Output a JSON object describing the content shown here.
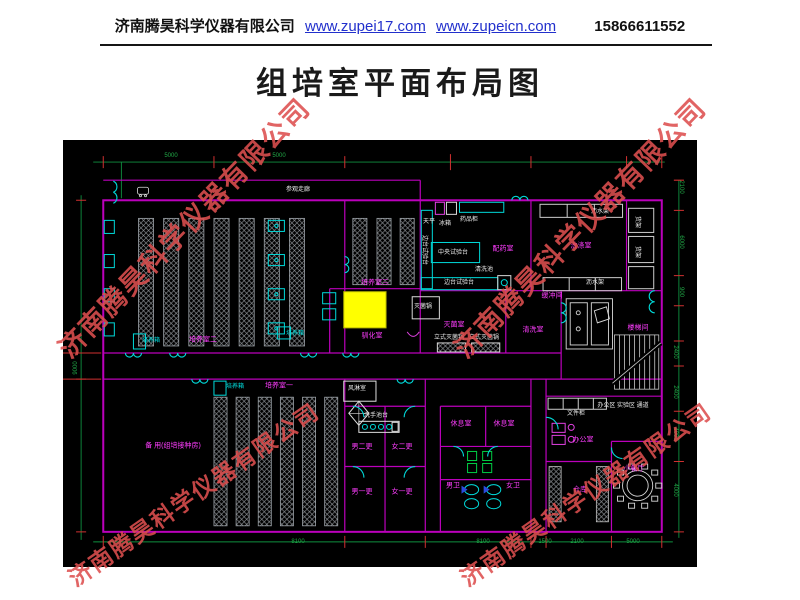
{
  "header": {
    "company": "济南腾昊科学仪器有限公司",
    "url1": "www.zupei17.com",
    "url2": "www.zupeicn.com",
    "phone": "15866611552"
  },
  "title": "组培室平面布局图",
  "watermark": {
    "text": "济南腾昊科学仪器有限公司",
    "color": "#dd4f4f",
    "instances": [
      {
        "x": 62,
        "y": 332,
        "r": -46,
        "s": 27
      },
      {
        "x": 458,
        "y": 332,
        "r": -46,
        "s": 27
      },
      {
        "x": 70,
        "y": 562,
        "r": -35,
        "s": 23
      },
      {
        "x": 462,
        "y": 562,
        "r": -35,
        "s": 23
      }
    ]
  },
  "colors": {
    "wall": "#bb00bb",
    "door": "#00d9d9",
    "room_label": "#ff3dff",
    "equipment": "#d8d8d8",
    "dimension": "#21a947",
    "tick": "#d03030",
    "highlight": "#ffff00",
    "plan_bg": "#000000"
  },
  "plan": {
    "labels": [
      {
        "t": "参观走廊",
        "c": "eq",
        "x": 235,
        "y": 50,
        "n": "label-visitor-corridor"
      },
      {
        "t": "培养室二",
        "c": "room",
        "x": 140,
        "y": 200,
        "n": "label-culture-room-2"
      },
      {
        "t": "培养室三",
        "c": "room",
        "x": 312,
        "y": 143,
        "n": "label-culture-room-3"
      },
      {
        "t": "驯化室",
        "c": "room",
        "x": 309,
        "y": 196,
        "n": "label-acclimatization-room"
      },
      {
        "t": "培养室一",
        "c": "room",
        "x": 216,
        "y": 246,
        "n": "label-culture-room-1"
      },
      {
        "t": "备 用(组培接种房)",
        "c": "room",
        "x": 110,
        "y": 306,
        "n": "label-spare-room"
      },
      {
        "t": "配药室",
        "c": "room",
        "x": 440,
        "y": 109,
        "n": "label-media-prep-room"
      },
      {
        "t": "洗涤室",
        "c": "room",
        "x": 518,
        "y": 106,
        "n": "label-washing-room"
      },
      {
        "t": "灭菌室",
        "c": "room",
        "x": 391,
        "y": 185,
        "n": "label-sterilization-room"
      },
      {
        "t": "清洗室",
        "c": "room",
        "x": 470,
        "y": 190,
        "n": "label-cleaning-room"
      },
      {
        "t": "缓冲间",
        "c": "room",
        "x": 489,
        "y": 156,
        "n": "label-buffer-room"
      },
      {
        "t": "楼梯间",
        "c": "room",
        "x": 575,
        "y": 188,
        "n": "label-stairwell"
      },
      {
        "t": "休息室",
        "c": "room",
        "x": 398,
        "y": 284,
        "n": "label-rest-room-1"
      },
      {
        "t": "休息室",
        "c": "room",
        "x": 441,
        "y": 284,
        "n": "label-rest-room-2"
      },
      {
        "t": "男二更",
        "c": "room",
        "x": 299,
        "y": 307,
        "n": "label-men-change-2"
      },
      {
        "t": "女二更",
        "c": "room",
        "x": 339,
        "y": 307,
        "n": "label-women-change-2"
      },
      {
        "t": "男一更",
        "c": "room",
        "x": 299,
        "y": 352,
        "n": "label-men-change-1"
      },
      {
        "t": "女一更",
        "c": "room",
        "x": 339,
        "y": 352,
        "n": "label-women-change-1"
      },
      {
        "t": "男卫",
        "c": "room",
        "x": 390,
        "y": 346,
        "n": "label-men-toilet"
      },
      {
        "t": "女卫",
        "c": "room",
        "x": 450,
        "y": 346,
        "n": "label-women-toilet"
      },
      {
        "t": "办公室",
        "c": "room",
        "x": 520,
        "y": 300,
        "n": "label-office"
      },
      {
        "t": "仓库",
        "c": "room",
        "x": 517,
        "y": 350,
        "n": "label-storage"
      },
      {
        "t": "小餐厅",
        "c": "room",
        "x": 571,
        "y": 329,
        "n": "label-small-dining"
      },
      {
        "t": "培养箱",
        "c": "cy",
        "x": 88,
        "y": 201,
        "n": "label-incubator"
      },
      {
        "t": "培养箱",
        "c": "cy",
        "x": 172,
        "y": 247,
        "n": "label-incubator"
      },
      {
        "t": "培养箱",
        "c": "cy",
        "x": 232,
        "y": 194,
        "n": "label-incubator"
      },
      {
        "t": "天平",
        "c": "eq",
        "x": 366,
        "y": 82,
        "n": "label-balance"
      },
      {
        "t": "冰箱",
        "c": "eq",
        "x": 382,
        "y": 84,
        "n": "label-fridge"
      },
      {
        "t": "药品柜",
        "c": "eq",
        "x": 406,
        "y": 80,
        "n": "label-medicine-cabinet"
      },
      {
        "t": "中央试验台",
        "c": "eq",
        "x": 390,
        "y": 113,
        "n": "label-central-bench"
      },
      {
        "t": "边台试验台",
        "c": "eq",
        "x": 361,
        "y": 110,
        "r": 90,
        "n": "label-side-bench"
      },
      {
        "t": "边台试验台",
        "c": "eq",
        "x": 396,
        "y": 143,
        "n": "label-side-bench"
      },
      {
        "t": "清洗池",
        "c": "eq",
        "x": 421,
        "y": 130,
        "n": "label-wash-sink"
      },
      {
        "t": "沥水架",
        "c": "eq",
        "x": 537,
        "y": 72,
        "n": "label-drain-rack"
      },
      {
        "t": "沥水架",
        "c": "eq",
        "x": 532,
        "y": 143,
        "n": "label-drain-rack"
      },
      {
        "t": "货架",
        "c": "eq",
        "x": 574,
        "y": 82,
        "r": 90,
        "n": "label-shelf"
      },
      {
        "t": "货架",
        "c": "eq",
        "x": 574,
        "y": 112,
        "r": 90,
        "n": "label-shelf"
      },
      {
        "t": "灭菌锅",
        "c": "eq",
        "x": 360,
        "y": 167,
        "n": "label-autoclave"
      },
      {
        "t": "立式灭菌锅",
        "c": "eq",
        "x": 386,
        "y": 198,
        "n": "label-vertical-autoclave"
      },
      {
        "t": "立式灭菌锅",
        "c": "eq",
        "x": 421,
        "y": 198,
        "n": "label-vertical-autoclave"
      },
      {
        "t": "风淋室",
        "c": "eq",
        "x": 294,
        "y": 249,
        "n": "label-air-shower"
      },
      {
        "t": "洗手池台",
        "c": "eq",
        "x": 313,
        "y": 276,
        "n": "label-hand-wash-counter"
      },
      {
        "t": "文件柜",
        "c": "eq",
        "x": 513,
        "y": 274,
        "n": "label-file-cabinet"
      },
      {
        "t": "办公区 实验区 通道",
        "c": "eq",
        "x": 560,
        "y": 266,
        "n": "label-corridor-note"
      },
      {
        "t": "5000",
        "c": "dim",
        "x": 108,
        "y": 16
      },
      {
        "t": "5000",
        "c": "dim",
        "x": 216,
        "y": 16
      },
      {
        "t": "9000",
        "c": "dim",
        "x": 13,
        "y": 228,
        "r": -90
      },
      {
        "t": "2100",
        "c": "dim",
        "x": 618,
        "y": 47,
        "r": 90
      },
      {
        "t": "6000",
        "c": "dim",
        "x": 618,
        "y": 102,
        "r": 90
      },
      {
        "t": "900",
        "c": "dim",
        "x": 618,
        "y": 152,
        "r": 90
      },
      {
        "t": "2400",
        "c": "dim",
        "x": 612,
        "y": 212,
        "r": 90
      },
      {
        "t": "2400",
        "c": "dim",
        "x": 612,
        "y": 252,
        "r": 90
      },
      {
        "t": "4000",
        "c": "dim",
        "x": 612,
        "y": 294,
        "r": 90
      },
      {
        "t": "4000",
        "c": "dim",
        "x": 612,
        "y": 350,
        "r": 90
      },
      {
        "t": "8100",
        "c": "dim",
        "x": 235,
        "y": 402
      },
      {
        "t": "8100",
        "c": "dim",
        "x": 420,
        "y": 402
      },
      {
        "t": "1500",
        "c": "dim",
        "x": 482,
        "y": 402
      },
      {
        "t": "2100",
        "c": "dim",
        "x": 514,
        "y": 402
      },
      {
        "t": "5000",
        "c": "dim",
        "x": 570,
        "y": 402
      }
    ]
  }
}
